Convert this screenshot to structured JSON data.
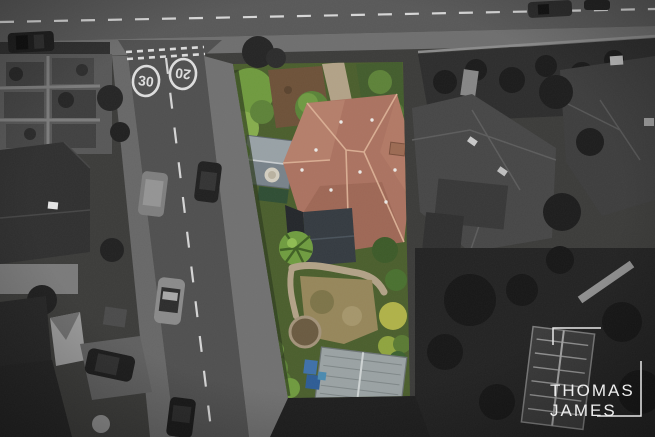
{
  "branding": {
    "line1": "THOMAS",
    "line2": "JAMES"
  },
  "road_markings": {
    "speed_limit_a": "30",
    "speed_limit_b": "20"
  },
  "palette": {
    "logo_white": "#eeeeee",
    "marking_white": "#dcdcdc",
    "asphalt": "#4f4f4f",
    "pavement": "#6e6e6e",
    "property_grass": "#4a5e2c",
    "hedge_green": "#6f9a3e",
    "bright_green": "#86ad4c",
    "soil_brown": "#6d5138",
    "roof_terracotta": "#ab7260",
    "roof_light": "#c08a74",
    "roof_dark": "#8e5a4a",
    "ridge_light": "#d9ad92",
    "slate_dark": "#343a40",
    "shed_grey": "#98a1a6",
    "stone_path": "#b2a287",
    "lawn_tan": "#96865a",
    "yellow_bush": "#b0b248",
    "bin_blue": "#3e70aa",
    "bin_blue_dark": "#2d5c95",
    "outbuilding_roof": "#9aa2a3"
  }
}
